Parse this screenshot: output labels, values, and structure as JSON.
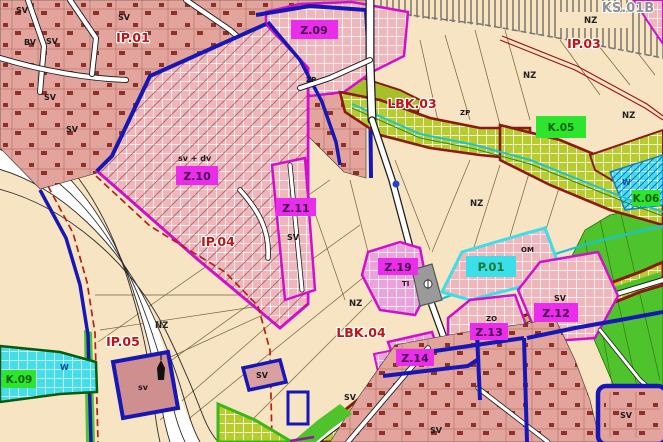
{
  "colors": {
    "beige": "#f6e4c2",
    "pink": "#e2a49c",
    "bldg": "#7c1d12",
    "hatchPinkBg": "#efb7bb",
    "hatchPurpBg": "#eca2da",
    "oliveBg": "#b8cc30",
    "zpGreen": "#a6bf2a",
    "cyanBg": "#44dde9",
    "brightGreen": "#4fc32b",
    "magenta": "#cf10cf",
    "magentaBox": "#ea2dea",
    "greenBox": "#2de52d",
    "cyanBox": "#3cdeea",
    "blue": "#1717b8",
    "darkRed": "#8c1a12",
    "labelRed": "#c01414",
    "labelGray": "#90909a",
    "cyanLine": "#19c3d4",
    "waterTextBlue": "#0a4a9a",
    "grayParcel": "#9a9a9a"
  },
  "labels": {
    "zones": {
      "z09": "Z.09",
      "z10": "Z.10",
      "z11": "Z.11",
      "z12": "Z.12",
      "z13": "Z.13",
      "z14": "Z.14",
      "z19": "Z.19"
    },
    "corridors": {
      "lbk03": "LBK.03",
      "lbk04": "LBK.04",
      "k05": "K.05",
      "k06": "K.06",
      "k09": "K.09"
    },
    "infrastructure": {
      "ip01": "IP.01",
      "ip03": "IP.03",
      "ip04": "IP.04",
      "ip05": "IP.05",
      "ks01b": "KS.01B",
      "p01": "P.01"
    },
    "areas": {
      "nz": "NZ",
      "sv": "SV",
      "sv_lower": "sv",
      "sv_dv": "sv + dv",
      "bv": "BV",
      "w": "W",
      "om": "OM",
      "ti": "TI",
      "zo": "ZO",
      "zp": "ZP"
    }
  }
}
